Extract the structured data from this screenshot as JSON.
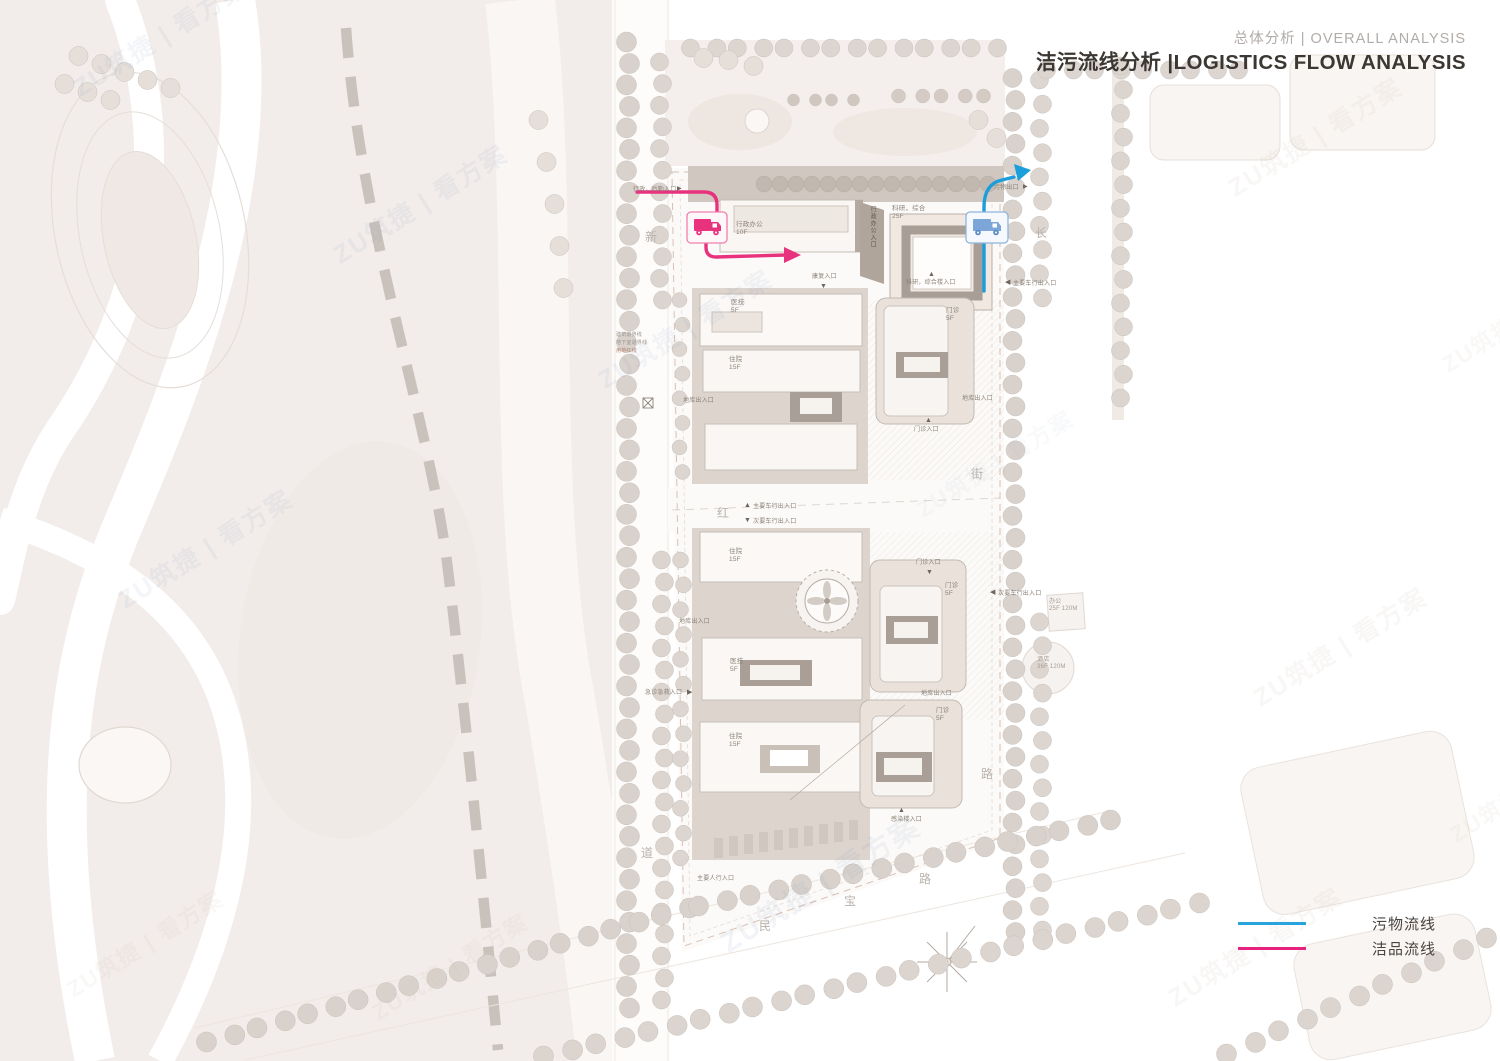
{
  "title": {
    "sub": "总体分析 | OVERALL ANALYSIS",
    "main": "洁污流线分析 |LOGISTICS FLOW ANALYSIS"
  },
  "legend": {
    "items": [
      {
        "label": "污物流线",
        "color": "#29a3db"
      },
      {
        "label": "洁品流线",
        "color": "#e6217e"
      }
    ]
  },
  "flows": {
    "waste": {
      "name": "污物流线",
      "color": "#1b9ed9"
    },
    "clean": {
      "name": "洁品流线",
      "color": "#e8327e"
    }
  },
  "watermark": {
    "text": "ZU筑捷 | 看方案"
  },
  "streets": [
    {
      "char": "新",
      "x": 645,
      "y": 228
    },
    {
      "char": "红",
      "x": 717,
      "y": 504
    },
    {
      "char": "道",
      "x": 641,
      "y": 844
    },
    {
      "char": "民",
      "x": 759,
      "y": 917
    },
    {
      "char": "宝",
      "x": 844,
      "y": 892
    },
    {
      "char": "路",
      "x": 919,
      "y": 870
    },
    {
      "char": "长",
      "x": 1035,
      "y": 224
    },
    {
      "char": "街",
      "x": 971,
      "y": 465
    },
    {
      "char": "路",
      "x": 981,
      "y": 765
    }
  ],
  "labels": [
    {
      "text": "行政，后勤入口",
      "x": 633,
      "y": 187,
      "s": 6,
      "n": "label-service-entrance"
    },
    {
      "text": "▶",
      "x": 677,
      "y": 186,
      "s": 6,
      "c": "#6e665e",
      "n": "entrance-marker"
    },
    {
      "text": "污物出口",
      "x": 994,
      "y": 185,
      "s": 6,
      "n": "label-waste-exit"
    },
    {
      "text": "▶",
      "x": 1023,
      "y": 184,
      "s": 6,
      "c": "#6e665e",
      "n": "entrance-marker"
    },
    {
      "text": "行政办公\n10F",
      "x": 736,
      "y": 221,
      "s": 6.5,
      "n": "label-admin-office"
    },
    {
      "text": "行政办公入口",
      "x": 868,
      "y": 206,
      "s": 6,
      "v": true,
      "c": "#5f5850",
      "n": "label-admin-entrance"
    },
    {
      "text": "科研，综合\n25F",
      "x": 892,
      "y": 205,
      "s": 6.5,
      "n": "label-research-building"
    },
    {
      "text": "▲",
      "x": 928,
      "y": 271,
      "s": 7,
      "c": "#6e665e",
      "n": "entrance-marker"
    },
    {
      "text": "科研，综合楼入口",
      "x": 906,
      "y": 280,
      "s": 6,
      "n": "label-research-entrance"
    },
    {
      "text": "◀",
      "x": 1005,
      "y": 279,
      "s": 7,
      "c": "#6e665e",
      "n": "entrance-marker"
    },
    {
      "text": "主要车行出入口",
      "x": 1013,
      "y": 281,
      "s": 6,
      "n": "label-main-vehicle-entrance-east"
    },
    {
      "text": "康复入口",
      "x": 812,
      "y": 274,
      "s": 6,
      "n": "label-rehab-entrance"
    },
    {
      "text": "▼",
      "x": 820,
      "y": 283,
      "s": 7,
      "c": "#6e665e",
      "n": "entrance-marker"
    },
    {
      "text": "医技\n5F",
      "x": 731,
      "y": 299,
      "s": 6.5,
      "n": "label-medtech-north"
    },
    {
      "text": "住院\n15F",
      "x": 729,
      "y": 356,
      "s": 6.5,
      "n": "label-inpatient-north"
    },
    {
      "text": "门诊\n5F",
      "x": 946,
      "y": 307,
      "s": 6.5,
      "n": "label-outpatient-ne"
    },
    {
      "text": "▲",
      "x": 925,
      "y": 417,
      "s": 7,
      "c": "#6e665e",
      "n": "entrance-marker"
    },
    {
      "text": "门诊入口",
      "x": 914,
      "y": 427,
      "s": 6,
      "n": "label-outpatient-entrance-north"
    },
    {
      "text": "地库出入口",
      "x": 962,
      "y": 396,
      "s": 6,
      "n": "label-garage-east"
    },
    {
      "text": "地库出入口",
      "x": 683,
      "y": 398,
      "s": 6,
      "n": "label-garage-west"
    },
    {
      "text": "建筑退界线",
      "x": 616,
      "y": 333,
      "s": 5,
      "c": "#9a918a",
      "n": "label-setback-building"
    },
    {
      "text": "地下室退界线",
      "x": 616,
      "y": 341,
      "s": 5,
      "c": "#9a918a",
      "n": "label-setback-basement"
    },
    {
      "text": "用地红线",
      "x": 616,
      "y": 349,
      "s": 5,
      "c": "#b3826f",
      "n": "label-red-line"
    },
    {
      "text": "▲",
      "x": 744,
      "y": 502,
      "s": 7,
      "c": "#6e665e",
      "n": "entrance-marker"
    },
    {
      "text": "主要车行出入口",
      "x": 753,
      "y": 504,
      "s": 6,
      "n": "label-main-vehicle-entrance"
    },
    {
      "text": "▼",
      "x": 744,
      "y": 517,
      "s": 7,
      "c": "#6e665e",
      "n": "entrance-marker"
    },
    {
      "text": "次要车行出入口",
      "x": 753,
      "y": 519,
      "s": 6,
      "n": "label-secondary-vehicle-entrance"
    },
    {
      "text": "住院\n15F",
      "x": 729,
      "y": 548,
      "s": 6.5,
      "n": "label-inpatient-mid"
    },
    {
      "text": "门诊入口",
      "x": 916,
      "y": 560,
      "s": 6,
      "n": "label-outpatient-entrance-mid"
    },
    {
      "text": "▼",
      "x": 926,
      "y": 569,
      "s": 7,
      "c": "#6e665e",
      "n": "entrance-marker"
    },
    {
      "text": "◀",
      "x": 990,
      "y": 589,
      "s": 7,
      "c": "#6e665e",
      "n": "entrance-marker"
    },
    {
      "text": "次要车行出入口",
      "x": 998,
      "y": 591,
      "s": 6,
      "n": "label-secondary-vehicle-entrance-east"
    },
    {
      "text": "办公\n25F 120M",
      "x": 1049,
      "y": 599,
      "s": 6,
      "c": "#a59c94",
      "n": "label-office-tower"
    },
    {
      "text": "酒店\n36F 120M",
      "x": 1037,
      "y": 657,
      "s": 6,
      "c": "#a59c94",
      "n": "label-hotel-tower"
    },
    {
      "text": "地库出入口",
      "x": 679,
      "y": 619,
      "s": 6,
      "n": "label-garage-southwest"
    },
    {
      "text": "医技\n5F",
      "x": 730,
      "y": 658,
      "s": 6.5,
      "n": "label-medtech-south"
    },
    {
      "text": "急诊急救入口",
      "x": 645,
      "y": 690,
      "s": 6,
      "n": "label-emergency-entrance"
    },
    {
      "text": "▶",
      "x": 687,
      "y": 689,
      "s": 7,
      "c": "#6e665e",
      "n": "entrance-marker"
    },
    {
      "text": "门诊\n5F",
      "x": 945,
      "y": 582,
      "s": 6.5,
      "n": "label-outpatient-se1"
    },
    {
      "text": "地库出入口",
      "x": 921,
      "y": 691,
      "s": 6,
      "n": "label-garage-southeast"
    },
    {
      "text": "门诊\n5F",
      "x": 936,
      "y": 707,
      "s": 6.5,
      "n": "label-outpatient-se2"
    },
    {
      "text": "住院\n15F",
      "x": 729,
      "y": 733,
      "s": 6.5,
      "n": "label-inpatient-south"
    },
    {
      "text": "▲",
      "x": 898,
      "y": 807,
      "s": 7,
      "c": "#6e665e",
      "n": "entrance-marker"
    },
    {
      "text": "感染楼入口",
      "x": 891,
      "y": 817,
      "s": 6,
      "n": "label-infection-entrance"
    },
    {
      "text": "主要人行入口",
      "x": 697,
      "y": 876,
      "s": 6,
      "n": "label-main-pedestrian-entrance"
    }
  ]
}
